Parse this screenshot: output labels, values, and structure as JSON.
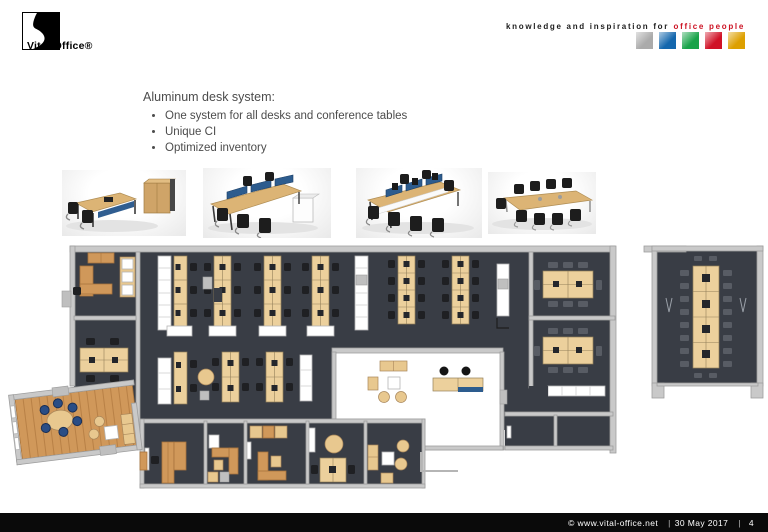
{
  "header": {
    "logo_text": "Vital-Office®",
    "tagline_black": "knowledge and inspiration for",
    "tagline_red": "office people",
    "squares": [
      {
        "name": "silver-square",
        "color": "#ababab"
      },
      {
        "name": "blue-square",
        "color": "#1467ad"
      },
      {
        "name": "green-square",
        "color": "#18a349"
      },
      {
        "name": "red-square",
        "color": "#d01126"
      },
      {
        "name": "gold-square",
        "color": "#dda000"
      }
    ]
  },
  "content": {
    "title": "Aluminum desk system:",
    "bullets": [
      "One system for all desks and conference tables",
      "Unique CI",
      "Optimized inventory"
    ]
  },
  "footer": {
    "copyright": "© www.vital-office.net",
    "divider": "|",
    "date": "30 May 2017",
    "page": "4"
  },
  "plan_colors": {
    "floor": "#393d45",
    "desk": "#ecd09c",
    "wood": "#d0985a",
    "wall": "#c9c9c9",
    "accent_blue": "#2d5c8e"
  }
}
